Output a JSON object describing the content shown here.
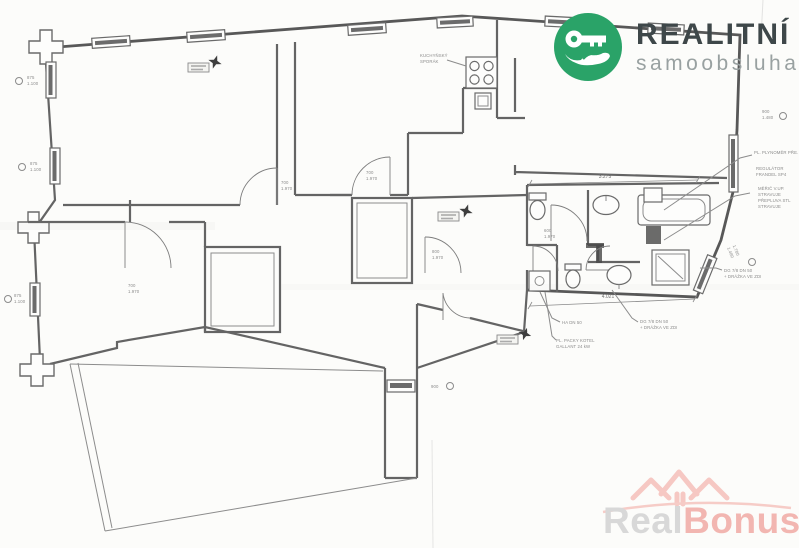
{
  "branding": {
    "title": "REALITNÍ",
    "subtitle": "samoobsluha",
    "accent_green": "#2aa368",
    "title_color": "#3e4749",
    "subtitle_color": "#99a1a1",
    "icon": "key-in-hand-icon"
  },
  "watermark": {
    "part_gray": "Real",
    "part_pink": "Bonus",
    "suffix": ".cz",
    "pink": "#f2b6b1",
    "gray": "#d8d8d8",
    "icon": "rooftops-arc-icon"
  },
  "plan": {
    "kitchen_note_1": "KUCHYŇSKÝ",
    "kitchen_note_2": "SPORÁK",
    "dim_bath_top": "3.275",
    "dim_bath_bottom": "4.021",
    "dim_slant_1": "1.780",
    "dim_slant_2": "1.480",
    "win_left_1a": "875",
    "win_left_1b": "1.100",
    "win_left_2a": "875",
    "win_left_2b": "1.100",
    "win_left_3a": "875",
    "win_left_3b": "1.100",
    "win_right_1a": "900",
    "win_right_1b": "1.480",
    "win_corridor": "900",
    "door_a_1": "700",
    "door_a_2": "1.970",
    "door_b_1": "700",
    "door_b_2": "1.970",
    "door_h_1": "700",
    "door_h_2": "1.970",
    "door_f_1": "800",
    "door_f_2": "1.970",
    "door_wc_1": "600",
    "door_wc_2": "1.970",
    "note_ha": "HA DN 50",
    "note_dg1a": "DG 7/8 DN 50",
    "note_dg1b": "+ DRÁŽKA VE ZDI",
    "note_dg2a": "DG 7/8 DN 50",
    "note_dg2b": "+ DRÁŽKA VE ZDI",
    "note_boiler_1": "PL. PACKY KOTEL",
    "note_boiler_2": "GALLANT 24 kW",
    "note_gas_1": "PL. PLYNOMĚR PŘE.",
    "note_gas_2": "REGULÁTOR",
    "note_gas_3": "FRANDEL SP4",
    "note_gas_4": "MĚŘIČ V.UP.",
    "note_gas_5": "STRAVUJE",
    "note_gas_6": "PŘEPLUVA STL",
    "note_gas_7": "STRAVUJE"
  }
}
